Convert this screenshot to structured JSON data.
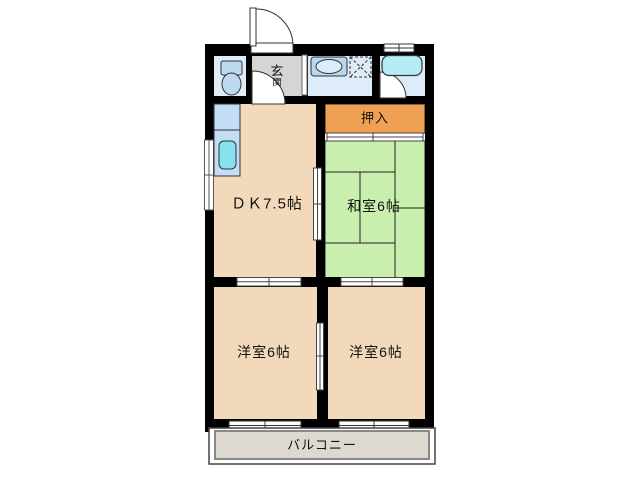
{
  "floorplan": {
    "labels": {
      "genkan_top": "玄",
      "genkan_bottom": "関",
      "oshiire": "押入",
      "dk": "ＤＫ7.5帖",
      "washitsu": "和室6帖",
      "yoshitsu_left": "洋室6帖",
      "yoshitsu_right": "洋室6帖",
      "balcony": "バルコニー"
    },
    "icons": {
      "toilet": "toilet-icon",
      "vanity_sink": "vanity-sink-icon",
      "washer_pan": "washing-machine-pan-icon",
      "bathtub": "bathtub-icon",
      "kitchen_sink": "kitchen-sink-icon",
      "door_swing": "door-swing-arc-icon",
      "sliding_door": "sliding-door-icon",
      "window": "window-icon"
    },
    "colors": {
      "wall": "#000000",
      "wood_floor": "#f2d9ba",
      "tatami_green": "#c9efae",
      "closet_orange": "#f0a052",
      "entry_gray": "#d5d5d5",
      "wet_area_blue": "#deebf8",
      "bathtub_cyan": "#b5ecf3",
      "kitchen_sink_cyan": "#86e3ed",
      "fixture_blue": "#bcd9f2",
      "balcony_gray": "#ded9d0"
    }
  }
}
